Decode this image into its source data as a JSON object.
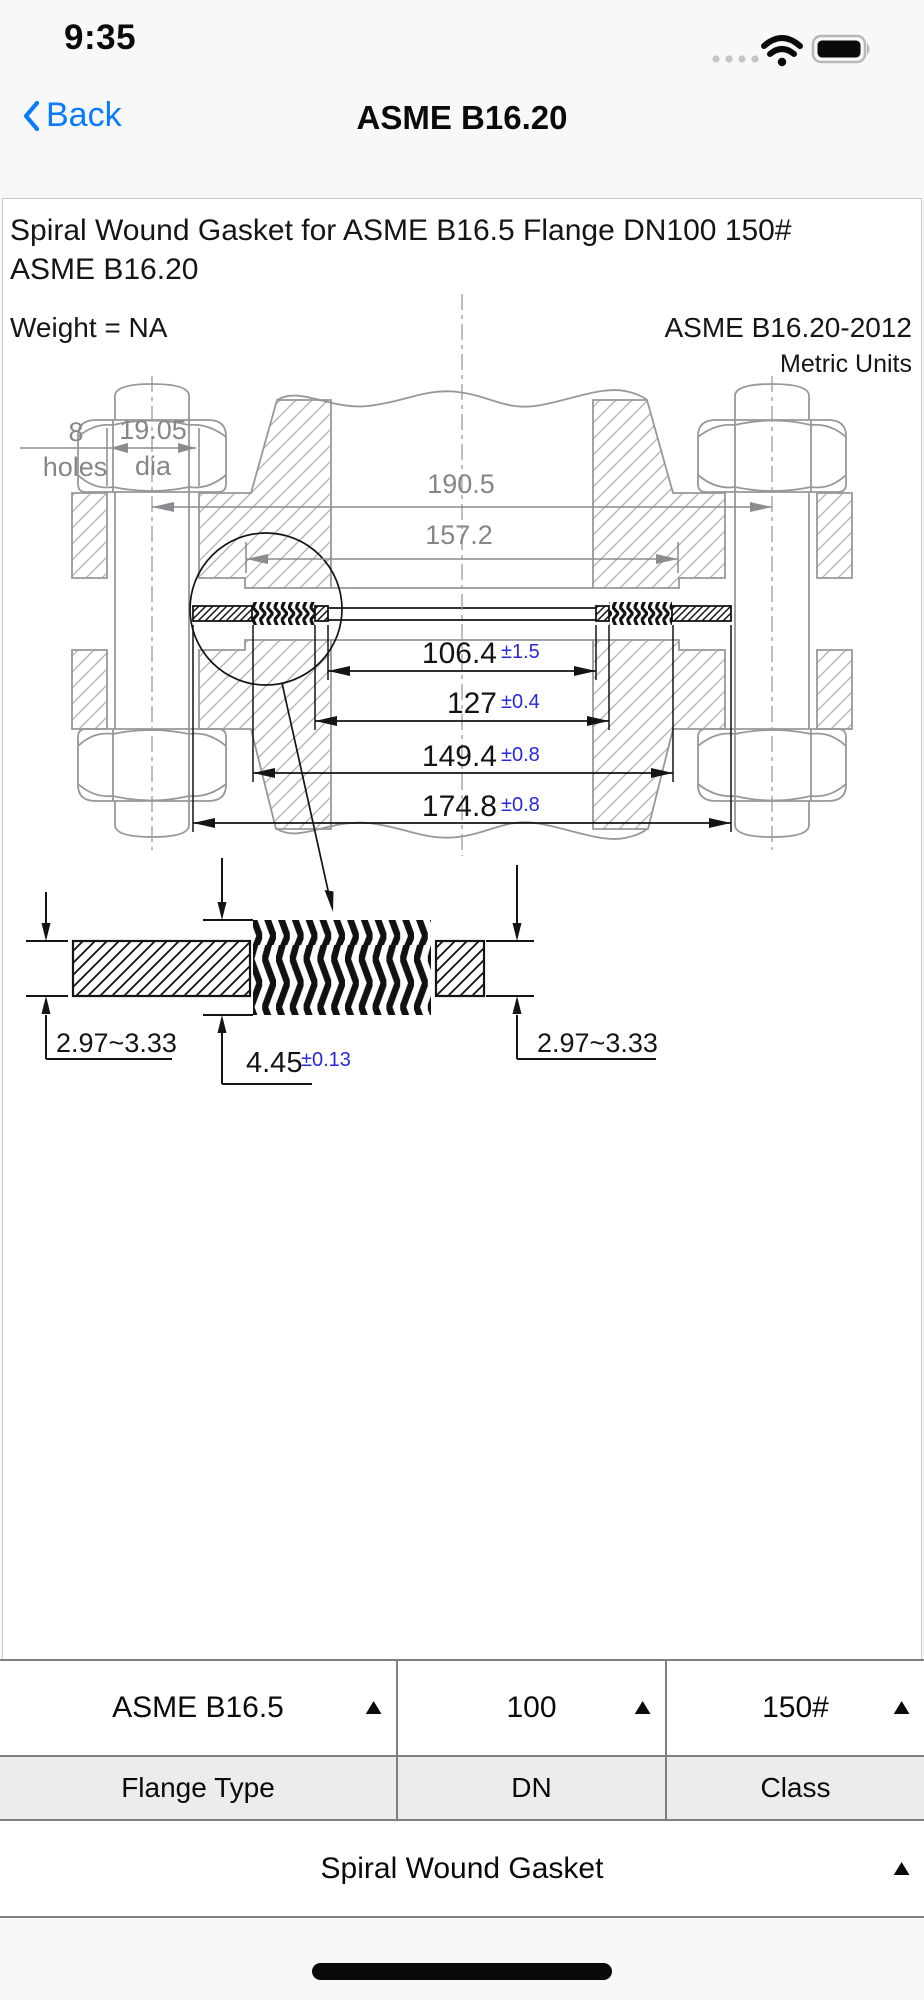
{
  "status": {
    "time": "9:35"
  },
  "nav": {
    "back_label": "Back",
    "title": "ASME B16.20"
  },
  "doc": {
    "title_line1": "Spiral Wound Gasket for ASME B16.5 Flange DN100 150#",
    "title_line2": "ASME B16.20",
    "weight": "Weight = NA",
    "standard": "ASME B16.20-2012",
    "units": "Metric Units"
  },
  "drawing": {
    "bolt_count": "8",
    "bolt_count_label": "holes",
    "bolt_hole_dia": "19.05",
    "bolt_hole_dia_label": "dia",
    "bolt_circle_dia": "190.5",
    "raised_face_dia": "157.2",
    "dims": [
      {
        "value": "106.4",
        "tol": "±1.5"
      },
      {
        "value": "127",
        "tol": "±0.4"
      },
      {
        "value": "149.4",
        "tol": "±0.8"
      },
      {
        "value": "174.8",
        "tol": "±0.8"
      }
    ],
    "detail": {
      "outer_ring_thickness": "2.97~3.33",
      "spiral_thickness": "4.45",
      "spiral_thickness_tol": "±0.13",
      "inner_ring_thickness": "2.97~3.33"
    },
    "colors": {
      "tolerance_blue": "#2828dd",
      "line_gray": "#97989b",
      "line_black": "#141414"
    }
  },
  "picker": {
    "columns": [
      {
        "value": "ASME B16.5",
        "label": "Flange Type"
      },
      {
        "value": "100",
        "label": "DN"
      },
      {
        "value": "150#",
        "label": "Class"
      }
    ],
    "gasket_type": "Spiral Wound Gasket"
  }
}
